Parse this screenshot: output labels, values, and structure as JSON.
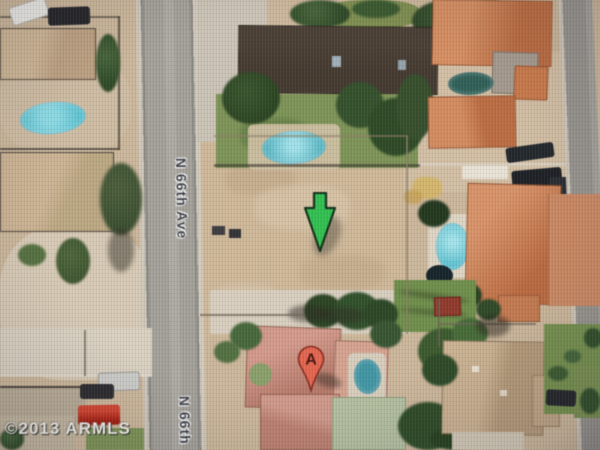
{
  "map": {
    "description": "Satellite aerial view of a residential neighborhood with a vacant dirt lot",
    "street": {
      "label_main": "N 66th Ave",
      "label_secondary": "N 66th"
    },
    "copyright": "©2013 ARMLS",
    "markers": {
      "arrow": {
        "type": "green-arrow"
      },
      "pin": {
        "type": "red-map-pin",
        "label": "A"
      }
    },
    "colors": {
      "dirt": "#ccb79b",
      "dirt_light": "#d8cab4",
      "concrete": "#d8cfbe",
      "road": "#a6a39c",
      "sidewalk": "#d2cabb",
      "lawn": "#7d9455",
      "tree": "#2e4a26",
      "pool": "#5cc4d2",
      "pool_dark": "#2e6057",
      "dark_roof": "#453a30",
      "tile_roof": "#cd8258",
      "salmon_roof": "#c8897a",
      "tan_roof": "#c3a987",
      "gray_roof": "#b9ac96",
      "arrow_green": "#2ec24e",
      "pin_red": "#e8654e",
      "label_text": "#3f4148"
    }
  }
}
